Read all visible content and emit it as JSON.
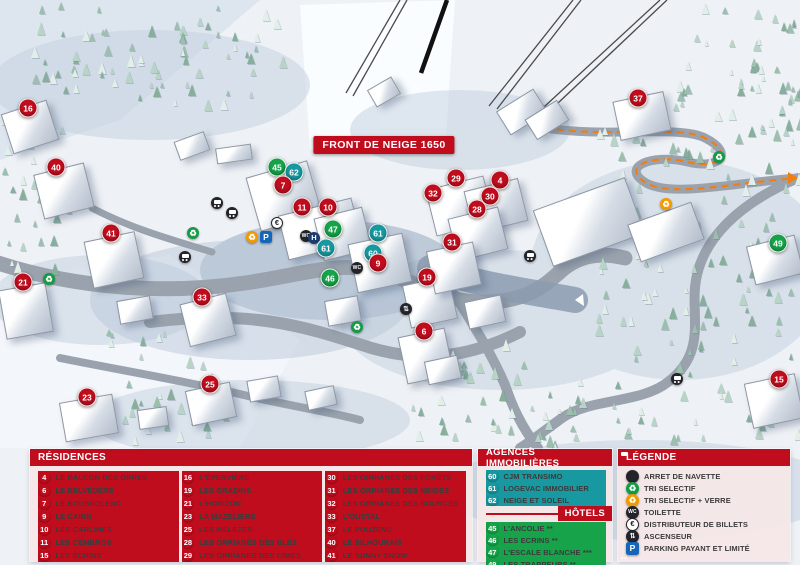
{
  "map": {
    "banner": "FRONT DE NEIGE 1650",
    "colors": {
      "residence_marker": "#c00d1e",
      "hotel_marker": "#17a34a",
      "agency_marker": "#1899a1",
      "header_red": "#c00d1e",
      "panel_bg": "#f6e7e7",
      "parking_blue": "#1666b8",
      "pedestrian_path_orange": "#f07f13"
    },
    "markers": [
      {
        "n": "16",
        "type": "residence",
        "x": 28,
        "y": 108
      },
      {
        "n": "40",
        "type": "residence",
        "x": 56,
        "y": 167
      },
      {
        "n": "37",
        "type": "residence",
        "x": 638,
        "y": 98
      },
      {
        "n": "45",
        "type": "hotel",
        "x": 277,
        "y": 167
      },
      {
        "n": "62",
        "type": "agency",
        "x": 294,
        "y": 172
      },
      {
        "n": "29",
        "type": "residence",
        "x": 456,
        "y": 178
      },
      {
        "n": "4",
        "type": "residence",
        "x": 500,
        "y": 180
      },
      {
        "n": "7",
        "type": "residence",
        "x": 283,
        "y": 185
      },
      {
        "n": "32",
        "type": "residence",
        "x": 433,
        "y": 193
      },
      {
        "n": "30",
        "type": "residence",
        "x": 490,
        "y": 196
      },
      {
        "n": "11",
        "type": "residence",
        "x": 302,
        "y": 207
      },
      {
        "n": "10",
        "type": "residence",
        "x": 328,
        "y": 207
      },
      {
        "n": "28",
        "type": "residence",
        "x": 477,
        "y": 209
      },
      {
        "n": "47",
        "type": "hotel",
        "x": 333,
        "y": 229
      },
      {
        "n": "41",
        "type": "residence",
        "x": 111,
        "y": 233
      },
      {
        "n": "61",
        "type": "agency",
        "x": 378,
        "y": 233
      },
      {
        "n": "31",
        "type": "residence",
        "x": 452,
        "y": 242
      },
      {
        "n": "49",
        "type": "hotel",
        "x": 778,
        "y": 243
      },
      {
        "n": "61",
        "type": "agency",
        "x": 326,
        "y": 248
      },
      {
        "n": "60",
        "type": "agency",
        "x": 373,
        "y": 253
      },
      {
        "n": "9",
        "type": "residence",
        "x": 378,
        "y": 263
      },
      {
        "n": "19",
        "type": "residence",
        "x": 427,
        "y": 277
      },
      {
        "n": "46",
        "type": "hotel",
        "x": 330,
        "y": 278
      },
      {
        "n": "21",
        "type": "residence",
        "x": 23,
        "y": 282
      },
      {
        "n": "33",
        "type": "residence",
        "x": 202,
        "y": 297
      },
      {
        "n": "6",
        "type": "residence",
        "x": 424,
        "y": 331
      },
      {
        "n": "15",
        "type": "residence",
        "x": 779,
        "y": 379
      },
      {
        "n": "25",
        "type": "residence",
        "x": 210,
        "y": 384
      },
      {
        "n": "23",
        "type": "residence",
        "x": 87,
        "y": 397
      }
    ],
    "icons": [
      {
        "icon": "bus-icon",
        "x": 217,
        "y": 203
      },
      {
        "icon": "bus-icon",
        "x": 232,
        "y": 213
      },
      {
        "icon": "bus-icon",
        "x": 185,
        "y": 257
      },
      {
        "icon": "bus-icon",
        "x": 530,
        "y": 256
      },
      {
        "icon": "bus-icon",
        "x": 677,
        "y": 379
      },
      {
        "icon": "recycle-green-icon",
        "x": 49,
        "y": 279
      },
      {
        "icon": "recycle-green-icon",
        "x": 193,
        "y": 233
      },
      {
        "icon": "recycle-green-icon",
        "x": 357,
        "y": 327
      },
      {
        "icon": "recycle-green-icon",
        "x": 719,
        "y": 157
      },
      {
        "icon": "recycle-orange-icon",
        "x": 252,
        "y": 237
      },
      {
        "icon": "recycle-orange-icon",
        "x": 666,
        "y": 204
      },
      {
        "icon": "parking-icon",
        "x": 266,
        "y": 237
      },
      {
        "icon": "atm-euro-icon",
        "x": 277,
        "y": 223
      },
      {
        "icon": "wc-icon",
        "x": 306,
        "y": 236
      },
      {
        "icon": "wc-icon",
        "x": 357,
        "y": 268
      },
      {
        "icon": "hotel-h-icon",
        "x": 314,
        "y": 238
      },
      {
        "icon": "elevator-icon",
        "x": 406,
        "y": 309
      }
    ],
    "labels": [
      {
        "text": "ESPACE LUGE",
        "x": 315,
        "y": 41,
        "cls": "poi-xs",
        "rot": -8
      },
      {
        "text": "à partir de 7 ans",
        "x": 313,
        "y": 57,
        "cls": "place",
        "rot": -8
      },
      {
        "text": "TÉLÉSKI DU PIC VERT",
        "x": 358,
        "y": 70,
        "cls": "lift",
        "rot": -62
      },
      {
        "text": "L'ORMAN EXPRESS LUGE",
        "x": 393,
        "y": 86,
        "cls": "poi",
        "w": 62
      },
      {
        "text": "TÉLÉSIÈGE DE BOIS LONG",
        "x": 518,
        "y": 67,
        "cls": "lift",
        "rot": -38
      },
      {
        "text": "TÉLÉSIÈGE DE MÉAN",
        "x": 565,
        "y": 77,
        "cls": "lift",
        "rot": -38
      },
      {
        "text": "SEMLORE REMONTÉES MÉCANIQUES POSTE DE SECOURS",
        "x": 536,
        "y": 124,
        "cls": "poi left",
        "w": 108
      },
      {
        "text": "CLUB PIOU PIOU ESF",
        "x": 196,
        "y": 132,
        "cls": "poi",
        "w": 48
      },
      {
        "text": "JARDIN DES NEIGES",
        "x": 243,
        "y": 141,
        "cls": "poi",
        "rot": -6
      },
      {
        "text": "HALTE-GARDERIE LES PITCHOUNETS",
        "x": 146,
        "y": 184,
        "cls": "poi",
        "w": 92
      },
      {
        "text": "VILLAGES",
        "x": 196,
        "y": 207,
        "cls": "poi"
      },
      {
        "text": "ESPACE LUGE",
        "x": 136,
        "y": 214,
        "cls": "poi-xs",
        "rot": -6
      },
      {
        "text": "moins de 6 ans",
        "x": 163,
        "y": 219,
        "cls": "place",
        "rot": -6
      },
      {
        "text": "CHAMP LACAS",
        "x": 253,
        "y": 216,
        "cls": "poi"
      },
      {
        "text": "Place du Festival",
        "x": 312,
        "y": 184,
        "cls": "place"
      },
      {
        "text": "LA BULLE ÉCOLE DU SKI FRANÇAIS",
        "x": 350,
        "y": 198,
        "cls": "poi",
        "w": 64
      },
      {
        "text": "CAISSES CENTRALES",
        "x": 399,
        "y": 181,
        "cls": "poi",
        "w": 56
      },
      {
        "text": "LAVERIE",
        "x": 466,
        "y": 153,
        "cls": "poi"
      },
      {
        "text": "ÉCOLE DE SKI OZONE",
        "x": 431,
        "y": 205,
        "cls": "poi",
        "w": 56
      },
      {
        "text": "CABINET MÉDICAL",
        "x": 394,
        "y": 215,
        "cls": "poi",
        "w": 46
      },
      {
        "text": "CINÉMA",
        "x": 397,
        "y": 232,
        "cls": "poi"
      },
      {
        "text": "Place Émile Audier",
        "x": 400,
        "y": 247,
        "cls": "place"
      },
      {
        "text": "GALERIE MARCHANDE",
        "x": 311,
        "y": 217,
        "cls": "poi",
        "w": 92
      },
      {
        "text": "Place d'Accueil",
        "x": 291,
        "y": 250,
        "cls": "place"
      },
      {
        "text": "OFFICE DE TOURISME",
        "x": 252,
        "y": 258,
        "cls": "poi",
        "rot": -10,
        "w": 92
      },
      {
        "text": "BIBLIOTHÈQUE",
        "x": 229,
        "y": 266,
        "cls": "poi",
        "rot": -10
      },
      {
        "text": "POSTE",
        "x": 266,
        "y": 270,
        "cls": "poi"
      },
      {
        "text": "DÉPOSE CARS",
        "x": 244,
        "y": 283,
        "cls": "poi",
        "rot": -10
      },
      {
        "text": "POLICE MUNICIPALE",
        "x": 282,
        "y": 285,
        "cls": "poi",
        "w": 52
      },
      {
        "text": "SALLE DE SPECTACLES",
        "x": 430,
        "y": 290,
        "cls": "poi",
        "w": 50
      },
      {
        "text": "GENDARMERIE",
        "x": 433,
        "y": 302,
        "cls": "poi"
      },
      {
        "text": "PATINOIRE",
        "x": 586,
        "y": 218,
        "cls": "poi-lg"
      },
      {
        "text": "PATINOIRE",
        "x": 553,
        "y": 258,
        "cls": "poi"
      },
      {
        "text": "VERS EMBRUN",
        "x": 553,
        "y": 286,
        "cls": "dir",
        "rot": 25
      },
      {
        "text": "ESPACE RENCONTRE ET CULTURE",
        "x": 670,
        "y": 230,
        "cls": "poi",
        "w": 80
      },
      {
        "text": "CHEMIN PIÉTONNIER",
        "x": 751,
        "y": 176,
        "cls": "poi-xs"
      },
      {
        "text": "VERS LES ORRES 1800",
        "x": 752,
        "y": 184,
        "cls": "poi-xs"
      },
      {
        "text": "BOIS MÉAN",
        "x": 740,
        "y": 192,
        "cls": "poi-xs"
      },
      {
        "text": "CHEMIN DU RIOU SEC",
        "x": 704,
        "y": 381,
        "cls": "poi",
        "w": 70
      },
      {
        "text": "ALLÉE DES CHAMOIS",
        "x": 100,
        "y": 282,
        "cls": "road",
        "rot": -7
      },
      {
        "text": "PONT SKIEURS",
        "x": 165,
        "y": 273,
        "cls": "road-sm",
        "rot": -12
      },
      {
        "text": "VERS MÉAN ET EMBRUN",
        "x": 150,
        "y": 259,
        "cls": "poi-xs"
      },
      {
        "text": "ROUTE DE PRAMOUTON",
        "x": 322,
        "y": 317,
        "cls": "road",
        "rot": 9
      },
      {
        "text": "CHEMIN DU MOUFLON",
        "x": 362,
        "y": 344,
        "cls": "road",
        "rot": 7
      },
      {
        "text": "CHEMIN DU GRAND CORBEAU",
        "x": 485,
        "y": 339,
        "cls": "road-sm",
        "rot": -58
      }
    ]
  },
  "legend": {
    "residences": {
      "title": "RÉSIDENCES",
      "items": [
        {
          "n": "4",
          "type": "residence",
          "label": "LE BALCON DES ORRES"
        },
        {
          "n": "6",
          "type": "residence",
          "label": "LE BELVÉDÈRE"
        },
        {
          "n": "7",
          "type": "residence",
          "label": "LE BOUSSOLENC"
        },
        {
          "n": "9",
          "type": "residence",
          "label": "LE CAIRN"
        },
        {
          "n": "10",
          "type": "residence",
          "label": "LES CARLINES"
        },
        {
          "n": "11",
          "type": "residence",
          "label": "LES CEMBROS"
        },
        {
          "n": "15",
          "type": "residence",
          "label": "LES ÉCRINS"
        },
        {
          "n": "16",
          "type": "residence",
          "label": "L'ÉPERVIÈRE"
        },
        {
          "n": "19",
          "type": "residence",
          "label": "LES GRADINS"
        },
        {
          "n": "21",
          "type": "residence",
          "label": "L'HORIZON"
        },
        {
          "n": "23",
          "type": "residence",
          "label": "LA MAZELIÈRE"
        },
        {
          "n": "25",
          "type": "residence",
          "label": "LES MÉLÈZES"
        },
        {
          "n": "28",
          "type": "residence",
          "label": "LES ORRIANES DES BLÉS"
        },
        {
          "n": "29",
          "type": "residence",
          "label": "LES ORRIANES DES CIMES"
        },
        {
          "n": "30",
          "type": "residence",
          "label": "LES ORRIANES DES FORÊTS"
        },
        {
          "n": "31",
          "type": "residence",
          "label": "LES ORRIANES DES NEIGES"
        },
        {
          "n": "32",
          "type": "residence",
          "label": "LES ORRIANES DES SOURCES"
        },
        {
          "n": "33",
          "type": "residence",
          "label": "L'OUSTAL"
        },
        {
          "n": "37",
          "type": "residence",
          "label": "LE POUZENC"
        },
        {
          "n": "40",
          "type": "residence",
          "label": "LE SILHOURAÏS"
        },
        {
          "n": "41",
          "type": "residence",
          "label": "LE SUNNY SNOW"
        }
      ]
    },
    "agences": {
      "title": "AGENCES IMMOBILIÈRES",
      "items": [
        {
          "n": "60",
          "type": "agency",
          "label": "CJM TRANSIMO"
        },
        {
          "n": "61",
          "type": "agency",
          "label": "LOGEVAC IMMOBILIER"
        },
        {
          "n": "62",
          "type": "agency",
          "label": "NEIGE ET SOLEIL"
        }
      ]
    },
    "hotels": {
      "title": "HÔTELS",
      "items": [
        {
          "n": "45",
          "type": "hotel",
          "label": "L'ANCOLIE **"
        },
        {
          "n": "46",
          "type": "hotel",
          "label": "LES ECRINS **"
        },
        {
          "n": "47",
          "type": "hotel",
          "label": "L'ESCALE BLANCHE ***"
        },
        {
          "n": "49",
          "type": "hotel",
          "label": "LES TRAPPEURS **"
        }
      ]
    },
    "legende": {
      "title": "LÉGENDE",
      "items": [
        {
          "icon": "bus-icon",
          "label": "ARRET DE NAVETTE"
        },
        {
          "icon": "recycle-green-icon",
          "label": "TRI SELECTIF"
        },
        {
          "icon": "recycle-orange-icon",
          "label": "TRI SELECTIF + VERRE"
        },
        {
          "icon": "wc-icon",
          "label": "TOILETTE"
        },
        {
          "icon": "atm-euro-icon",
          "label": "DISTRIBUTEUR DE BILLETS"
        },
        {
          "icon": "elevator-icon",
          "label": "ASCENSEUR"
        },
        {
          "icon": "parking-icon",
          "label": "PARKING PAYANT ET LIMITÉ"
        }
      ]
    }
  }
}
